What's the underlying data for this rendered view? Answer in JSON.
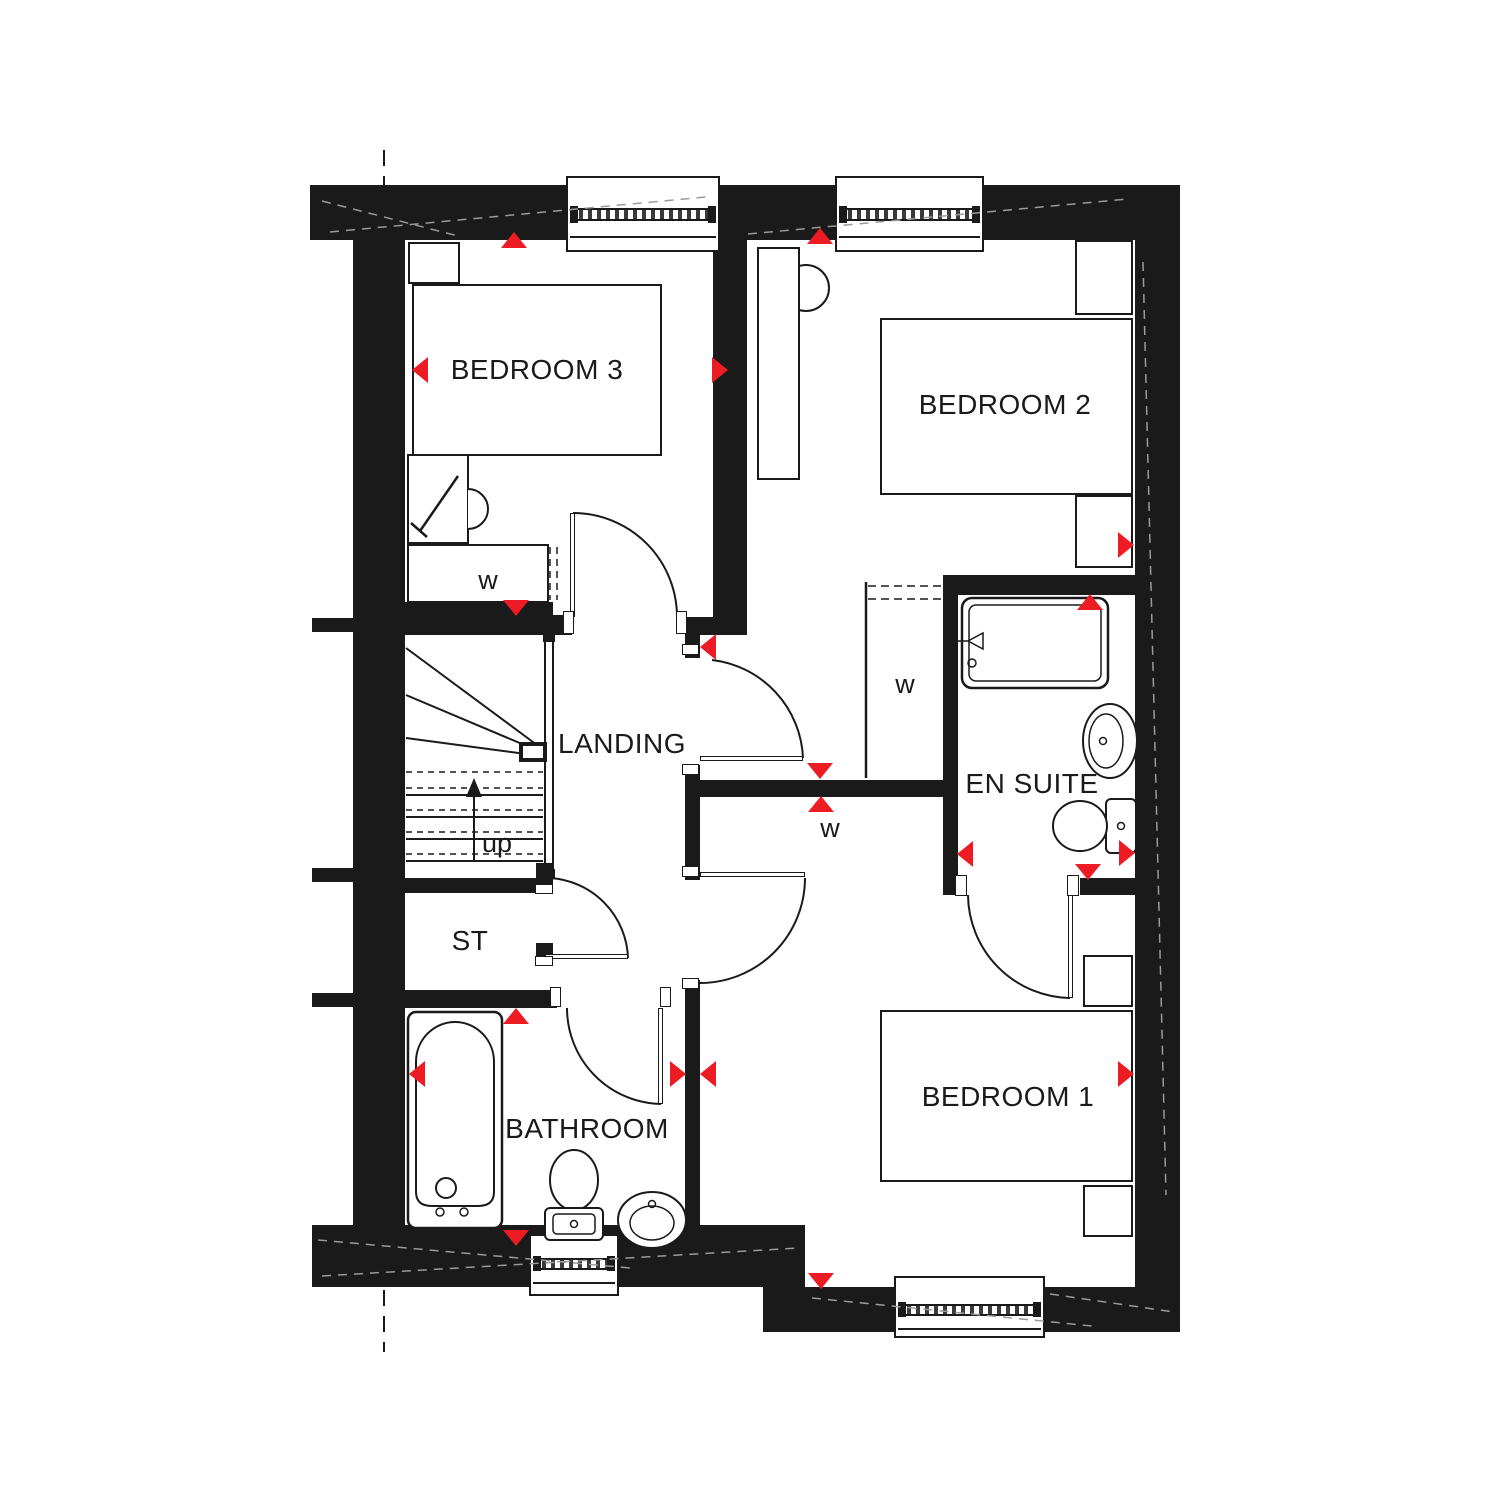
{
  "plan": {
    "accent_color": "#ED1C24",
    "line_color": "#1A1A1A",
    "rooms": [
      {
        "id": "bedroom-3",
        "label": "BEDROOM 3"
      },
      {
        "id": "bedroom-2",
        "label": "BEDROOM 2"
      },
      {
        "id": "landing",
        "label": "LANDING"
      },
      {
        "id": "en-suite",
        "label": "EN SUITE"
      },
      {
        "id": "storage",
        "label": "ST"
      },
      {
        "id": "bathroom",
        "label": "BATHROOM"
      },
      {
        "id": "bedroom-1",
        "label": "BEDROOM 1"
      }
    ],
    "annotations": {
      "wardrobe": "w",
      "stairs_direction": "up"
    }
  }
}
